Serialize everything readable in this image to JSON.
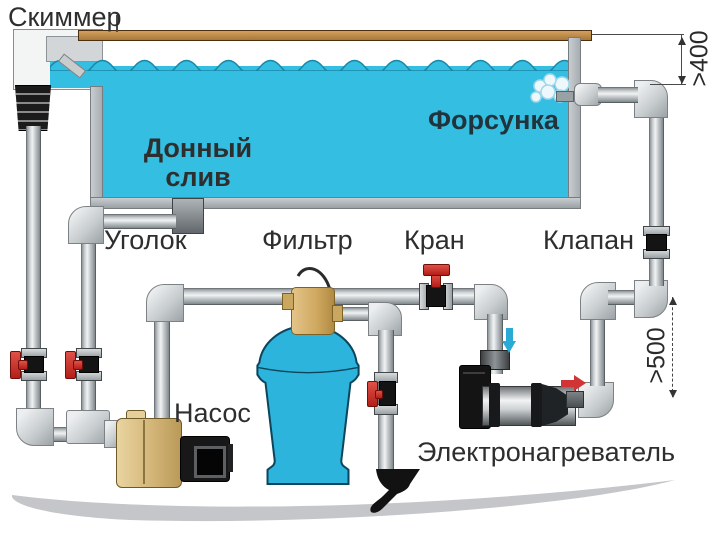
{
  "diagram_title": "Pool plumbing schematic (Russian labels)",
  "labels": {
    "skimmer": "Скиммер",
    "bottom_drain_line1": "Донный",
    "bottom_drain_line2": "слив",
    "nozzle": "Форсунка",
    "elbow": "Уголок",
    "filter": "Фильтр",
    "tap": "Кран",
    "check_valve": "Клапан",
    "pump": "Насос",
    "heater": "Электронагреватель"
  },
  "dimensions": {
    "skimmer_to_jet": ">400",
    "pipe_drop": ">500"
  },
  "icons": {
    "flow_down_arrow": "blue arrow pointing down into heater inlet",
    "flow_right_arrow": "red arrow pointing right at heater outlet",
    "splash": "water jet splash at nozzle"
  },
  "colors": {
    "water": "#34bee2",
    "water_outline": "#1787a8",
    "pipe_gray": "#c3c8ca",
    "valve_handle_red": "#c8342e",
    "filter_blue": "#2cb4dc",
    "pump_beige": "#dfc188",
    "deck_tan": "#bf8c4e",
    "ground_gray": "#c5c6ca",
    "text": "#2e2e2e"
  }
}
